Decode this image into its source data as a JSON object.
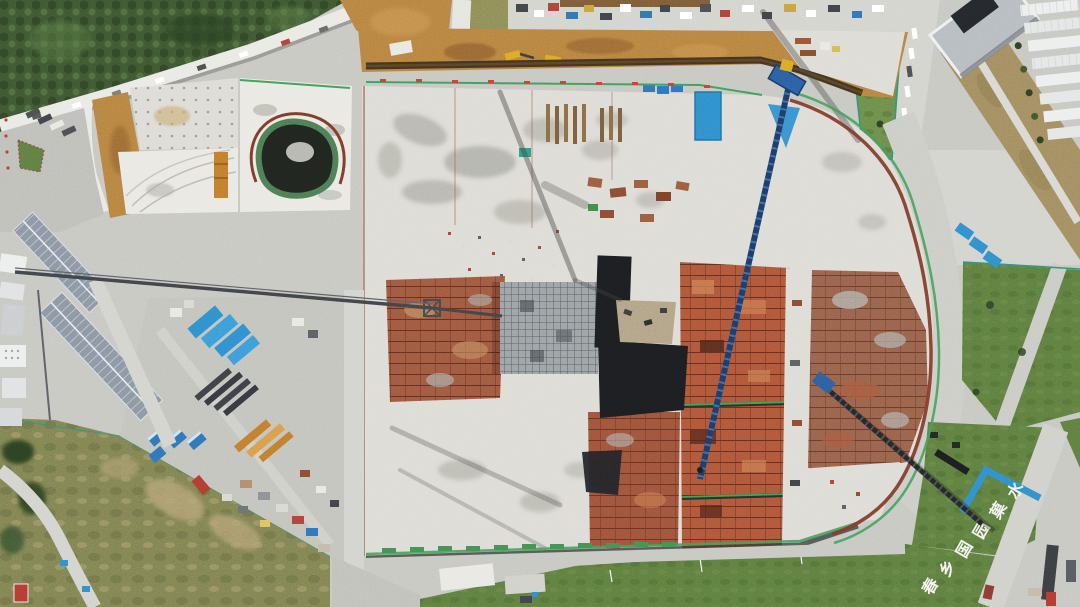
{
  "image": {
    "kind": "aerial drone photograph",
    "subject": "large construction site: excavated foundation with concrete slabs, rust-red rebar formwork zones, deep pit, tower and crawler cranes, material yards, site offices, perimeter roads and lawns",
    "width_px": 1080,
    "height_px": 607
  },
  "ground_text": {
    "location": "white characters laid on southeast lawn",
    "color": "#f2f2ee",
    "legibility": "low",
    "chars": [
      "水",
      "菓",
      "园",
      "国",
      "乡",
      "春"
    ]
  },
  "palette": {
    "base": "#c6c6c1",
    "road_light": "#d2d2cd",
    "slab": "#dcdbd5",
    "slab_bright": "#e9e8e2",
    "wet": "#a6a69f",
    "veg": "#3d5531",
    "veg_dark": "#2c4123",
    "veg_light": "#597844",
    "scrub": "#7d8050",
    "scrub_tan": "#b3a173",
    "lawn": "#5c7b3e",
    "lawn_dark": "#49672f",
    "dirt": "#b5803f",
    "dirt_dark": "#8a5c2e",
    "trench": "#3a2c1a",
    "rust_bright": "#ad5538",
    "rust_muted": "#9d573f",
    "rust_dark": "#59291c",
    "pit": "#1b1d20",
    "scaffold": "#9aa0a3",
    "tarp": "#2e8ccb",
    "container": "#2d72b8",
    "crane_navy": "#1d3a66",
    "crane_blue": "#2a5d9e",
    "machine_yellow": "#d9a823",
    "steel_orange": "#c07a2c",
    "fence": "#3e9c57",
    "fence_teal": "#2f8f7a",
    "guardrail": "#7c3a28",
    "roof_gray": "#b5babf",
    "building_bluegray": "#8793a0",
    "white": "#f2f2ee"
  }
}
